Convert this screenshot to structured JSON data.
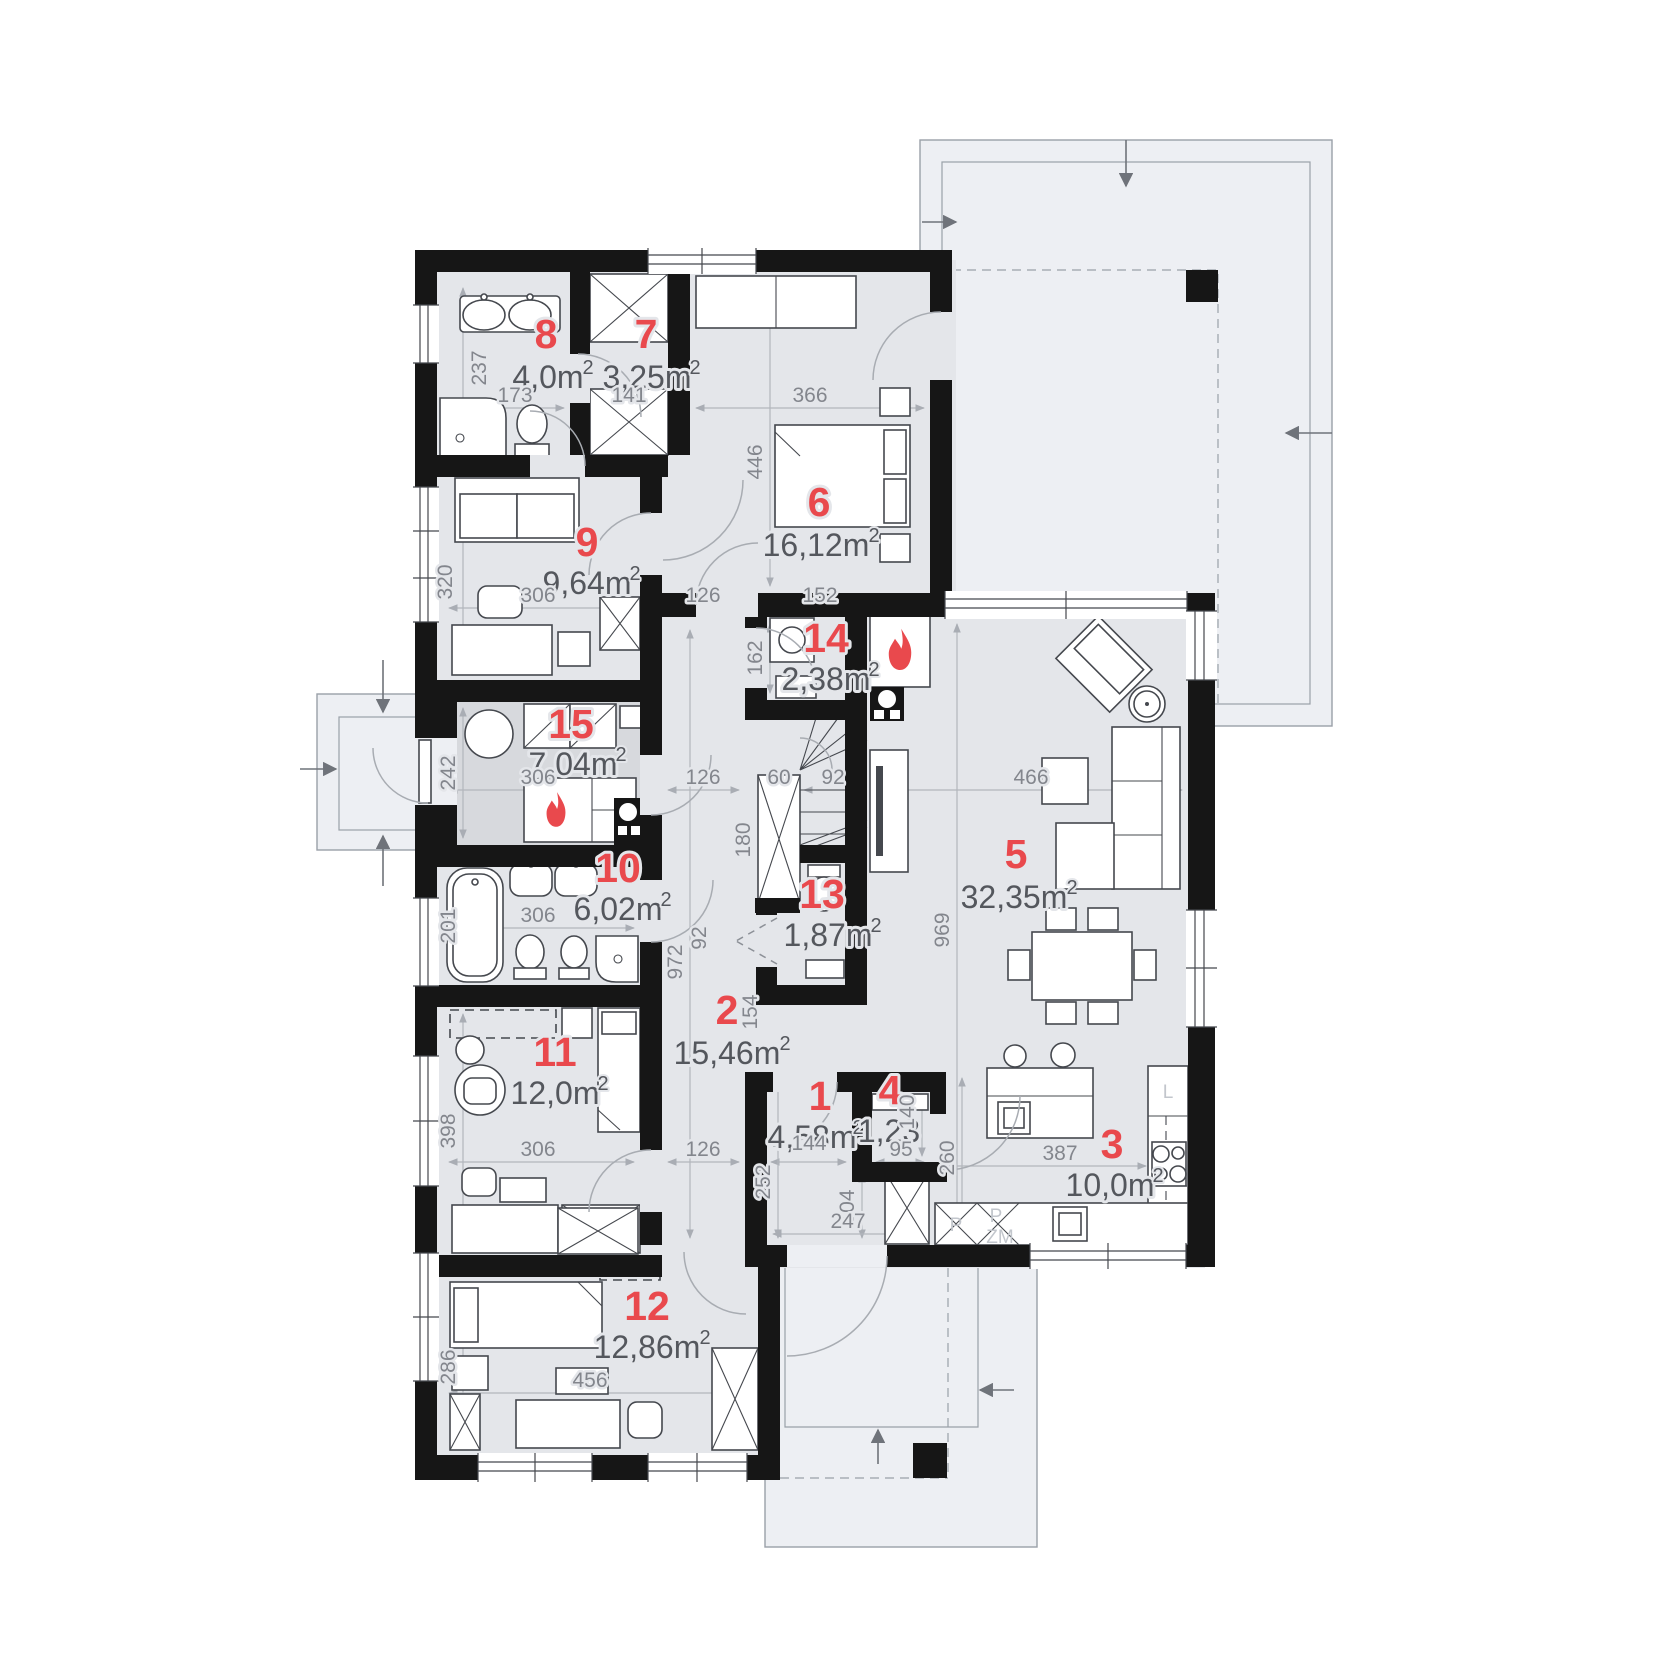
{
  "meta": {
    "sup": "2"
  },
  "rooms": [
    {
      "num": "1",
      "area": "4,58m"
    },
    {
      "num": "2",
      "area": "15,46m"
    },
    {
      "num": "3",
      "area": "10,0m"
    },
    {
      "num": "4",
      "area": "1,23"
    },
    {
      "num": "5",
      "area": "32,35m"
    },
    {
      "num": "6",
      "area": "16,12m"
    },
    {
      "num": "7",
      "area": "3,25m"
    },
    {
      "num": "8",
      "area": "4,0m"
    },
    {
      "num": "9",
      "area": "9,64m"
    },
    {
      "num": "10",
      "area": "6,02m"
    },
    {
      "num": "11",
      "area": "12,0m"
    },
    {
      "num": "12",
      "area": "12,86m"
    },
    {
      "num": "13",
      "area": "1,87m"
    },
    {
      "num": "14",
      "area": "2,38m"
    },
    {
      "num": "15",
      "area": "7,04m"
    }
  ],
  "dims": [
    "237",
    "173",
    "141",
    "366",
    "446",
    "320",
    "306",
    "126",
    "152",
    "162",
    "126",
    "60",
    "92",
    "180",
    "466",
    "969",
    "201",
    "306",
    "242",
    "306",
    "92",
    "972",
    "154",
    "398",
    "306",
    "126",
    "144",
    "95",
    "140",
    "260",
    "387",
    "252",
    "104",
    "247",
    "286",
    "456"
  ],
  "kitchen": {
    "fridge": "L",
    "p1": "P",
    "p2": "P",
    "zm": "ZM"
  }
}
